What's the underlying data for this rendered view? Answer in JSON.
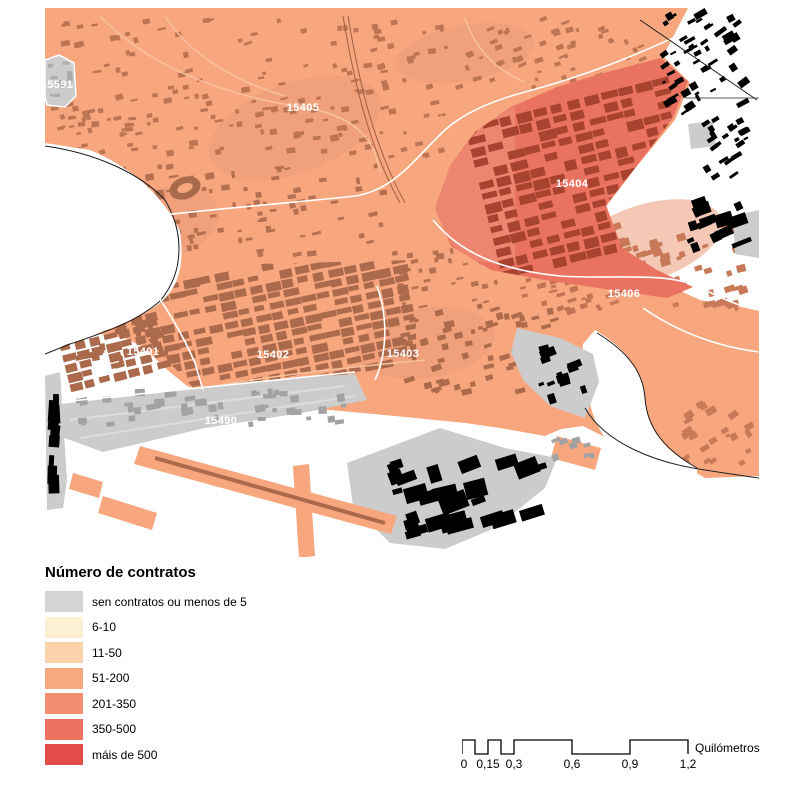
{
  "map": {
    "zone_labels": [
      "15591",
      "15405",
      "15404",
      "15406",
      "15401",
      "15402",
      "15403",
      "15490"
    ]
  },
  "legend": {
    "title": "Número de contratos",
    "items": [
      {
        "label": "sen contratos ou menos de 5",
        "color": "#D5D5D5"
      },
      {
        "label": "6-10",
        "color": "#FDF0D2"
      },
      {
        "label": "11-50",
        "color": "#FBD2AA"
      },
      {
        "label": "51-200",
        "color": "#F8A87E"
      },
      {
        "label": "201-350",
        "color": "#F28F70"
      },
      {
        "label": "350-500",
        "color": "#EE7260"
      },
      {
        "label": "máis de 500",
        "color": "#E14C48"
      }
    ]
  },
  "scalebar": {
    "ticks": [
      "0",
      "0,15",
      "0,3",
      "0,6",
      "0,9",
      "1,2"
    ],
    "unit": "Quilómetros"
  }
}
